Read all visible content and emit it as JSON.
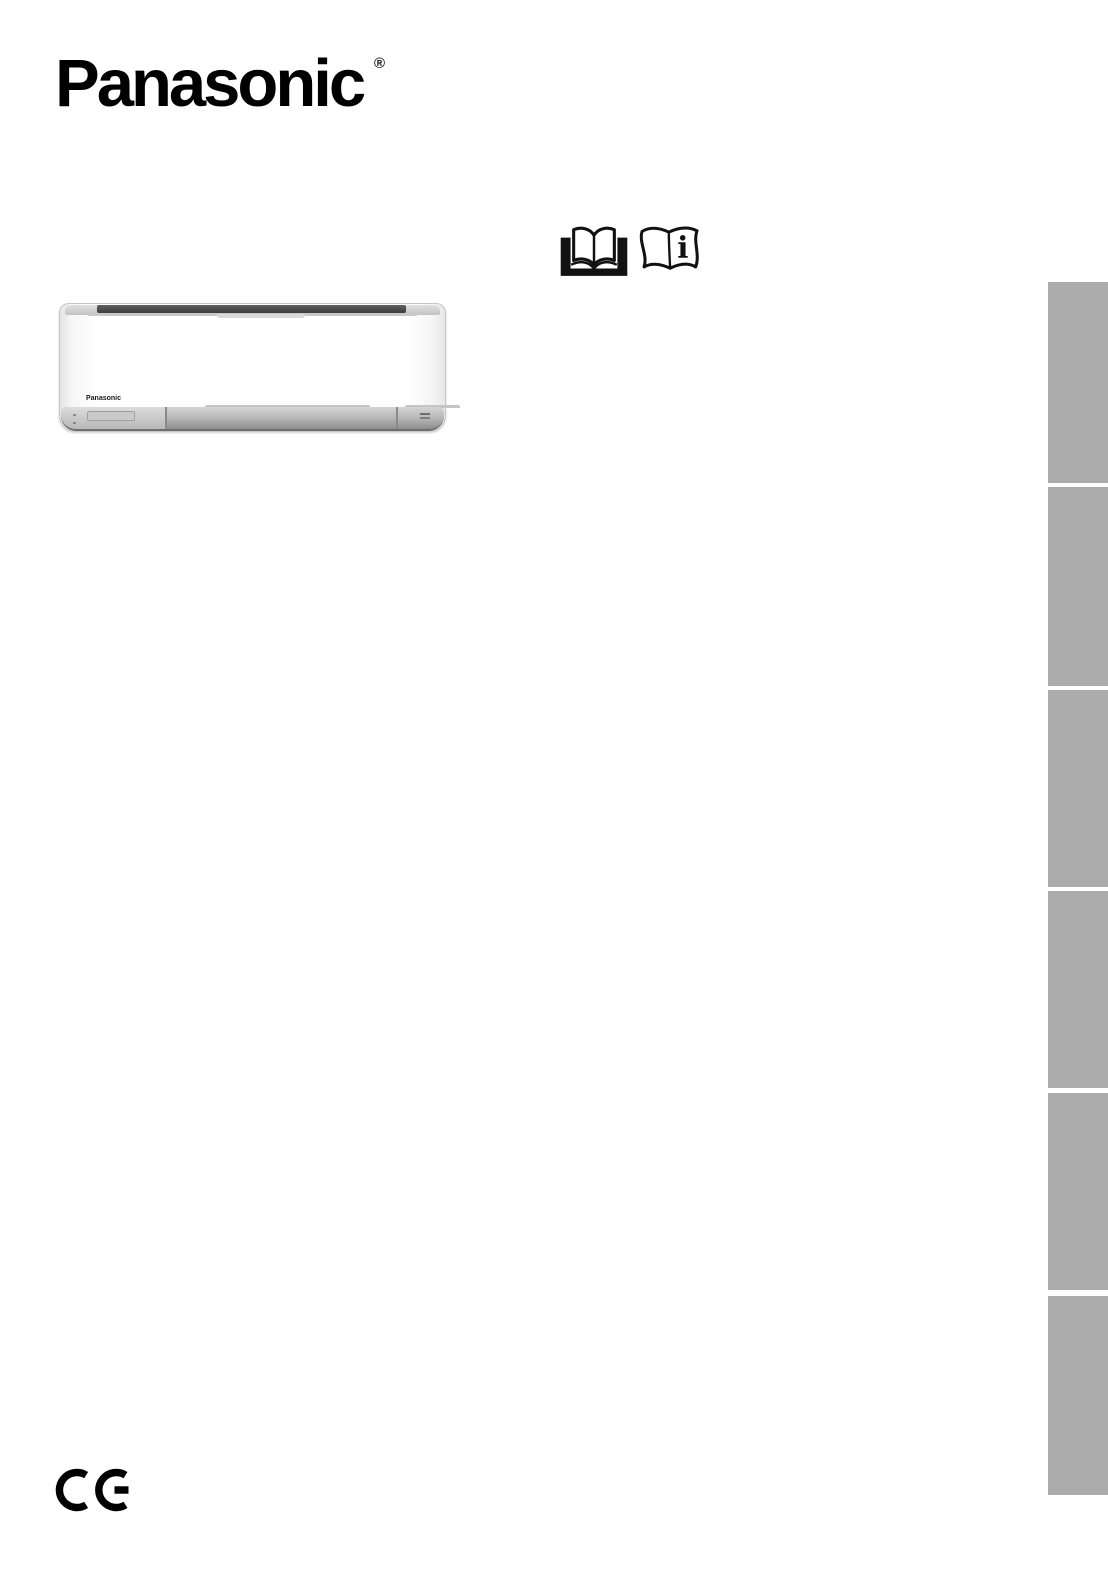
{
  "header": {
    "brand_logo": "Panasonic",
    "registered_symbol": "®"
  },
  "instruction_icons": {
    "read_manual_icon": "open-book-reading-icon",
    "info_booklet_icon": "instruction-booklet-info-icon",
    "info_glyph": "i"
  },
  "product": {
    "image_type": "wall-mounted air conditioner indoor unit",
    "unit_brand_label": "Panasonic"
  },
  "sidebar": {
    "tab_count": 6
  },
  "footer": {
    "ce_marking": "CE"
  },
  "colors": {
    "tab_gray": "#ACACAC",
    "intake_dark": "#474747",
    "panel_gray": "#A9A9A9"
  }
}
